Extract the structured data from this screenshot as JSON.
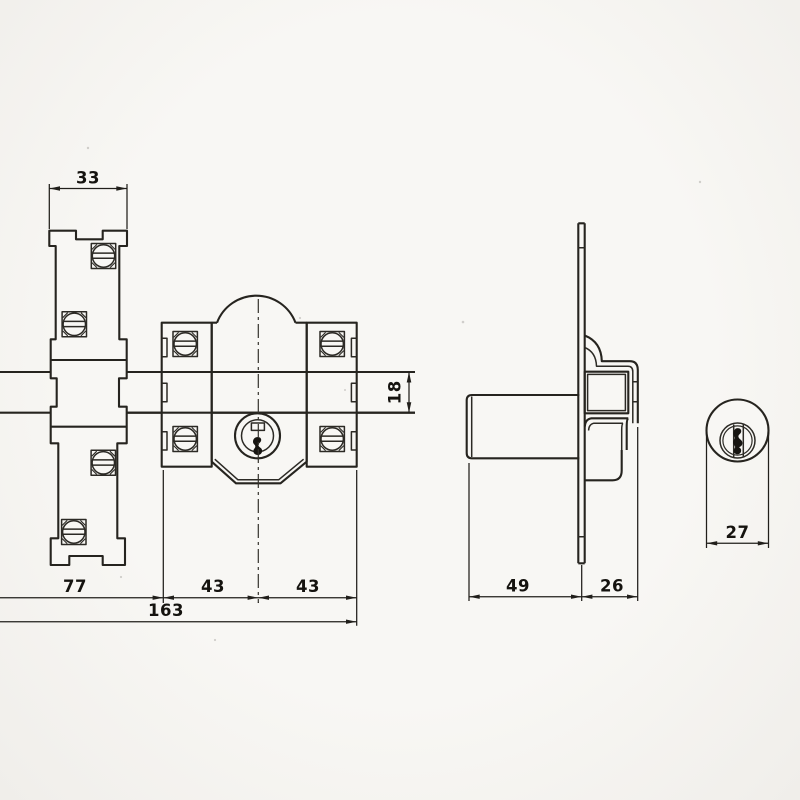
{
  "drawing": {
    "paper_color": "#f8f7f4",
    "ink_color": "#26241f",
    "views": {
      "front": "front view of lock body with strike plate and bolt bar",
      "side": "side view of cylinder with mounting plate and case",
      "face": "cylinder face view"
    }
  },
  "dims": {
    "plate_width": {
      "label": "33"
    },
    "bar_height": {
      "label": "18"
    },
    "left_span": {
      "label": "77"
    },
    "center_left": {
      "label": "43"
    },
    "center_right": {
      "label": "43"
    },
    "total_width": {
      "label": "163"
    },
    "cylinder_length": {
      "label": "49"
    },
    "plate_offset": {
      "label": "26"
    },
    "cylinder_diameter": {
      "label": "27"
    }
  }
}
